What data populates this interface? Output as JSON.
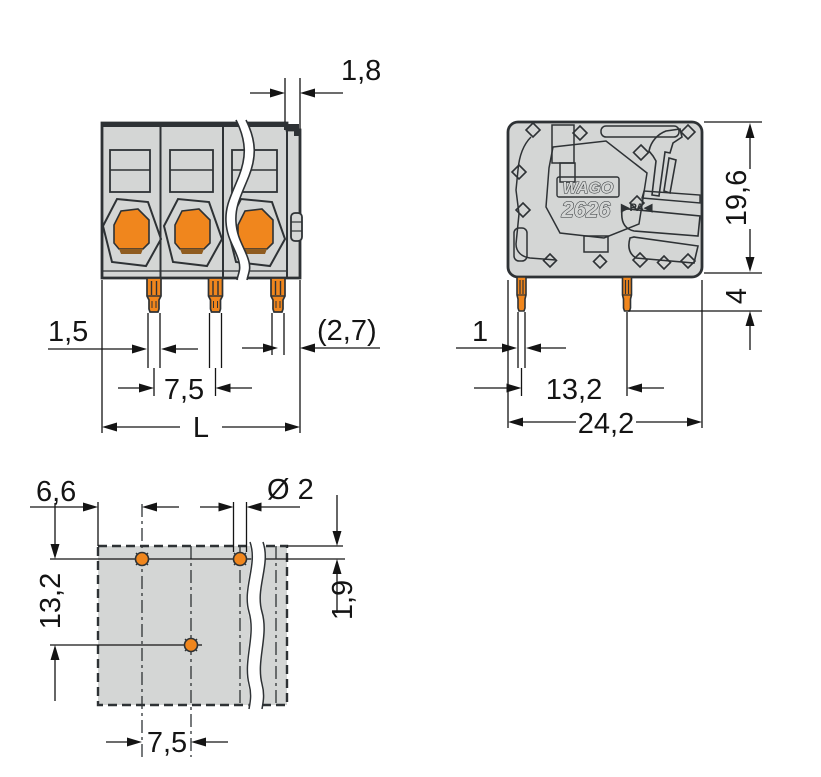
{
  "drawing_title": "PCB terminal block dimensional drawing",
  "front_view": {
    "dim_top_flange": "1,8",
    "dim_pin_width": "1,5",
    "dim_pin_edge": "(2,7)",
    "dim_pitch": "7,5",
    "dim_total_length": "L"
  },
  "side_view": {
    "dim_height": "19,6",
    "dim_pin_length": "4",
    "dim_pin_thickness": "1",
    "dim_pin_spacing": "13,2",
    "dim_total_depth": "24,2",
    "brand": "WAGO",
    "series": "2626",
    "material_marking": "▶PA◀"
  },
  "drilling_plan": {
    "dim_edge_to_hole": "6,6",
    "dim_hole_diameter": "Ø 2",
    "dim_row_spacing": "13,2",
    "dim_top_offset": "1,9",
    "dim_hole_pitch": "7,5"
  },
  "colors": {
    "body_gray": "#d4d6d5",
    "outline": "#2e3235",
    "orange": "#f0861d",
    "orange_shadow": "#8f5c20",
    "dimension": "#141414"
  }
}
